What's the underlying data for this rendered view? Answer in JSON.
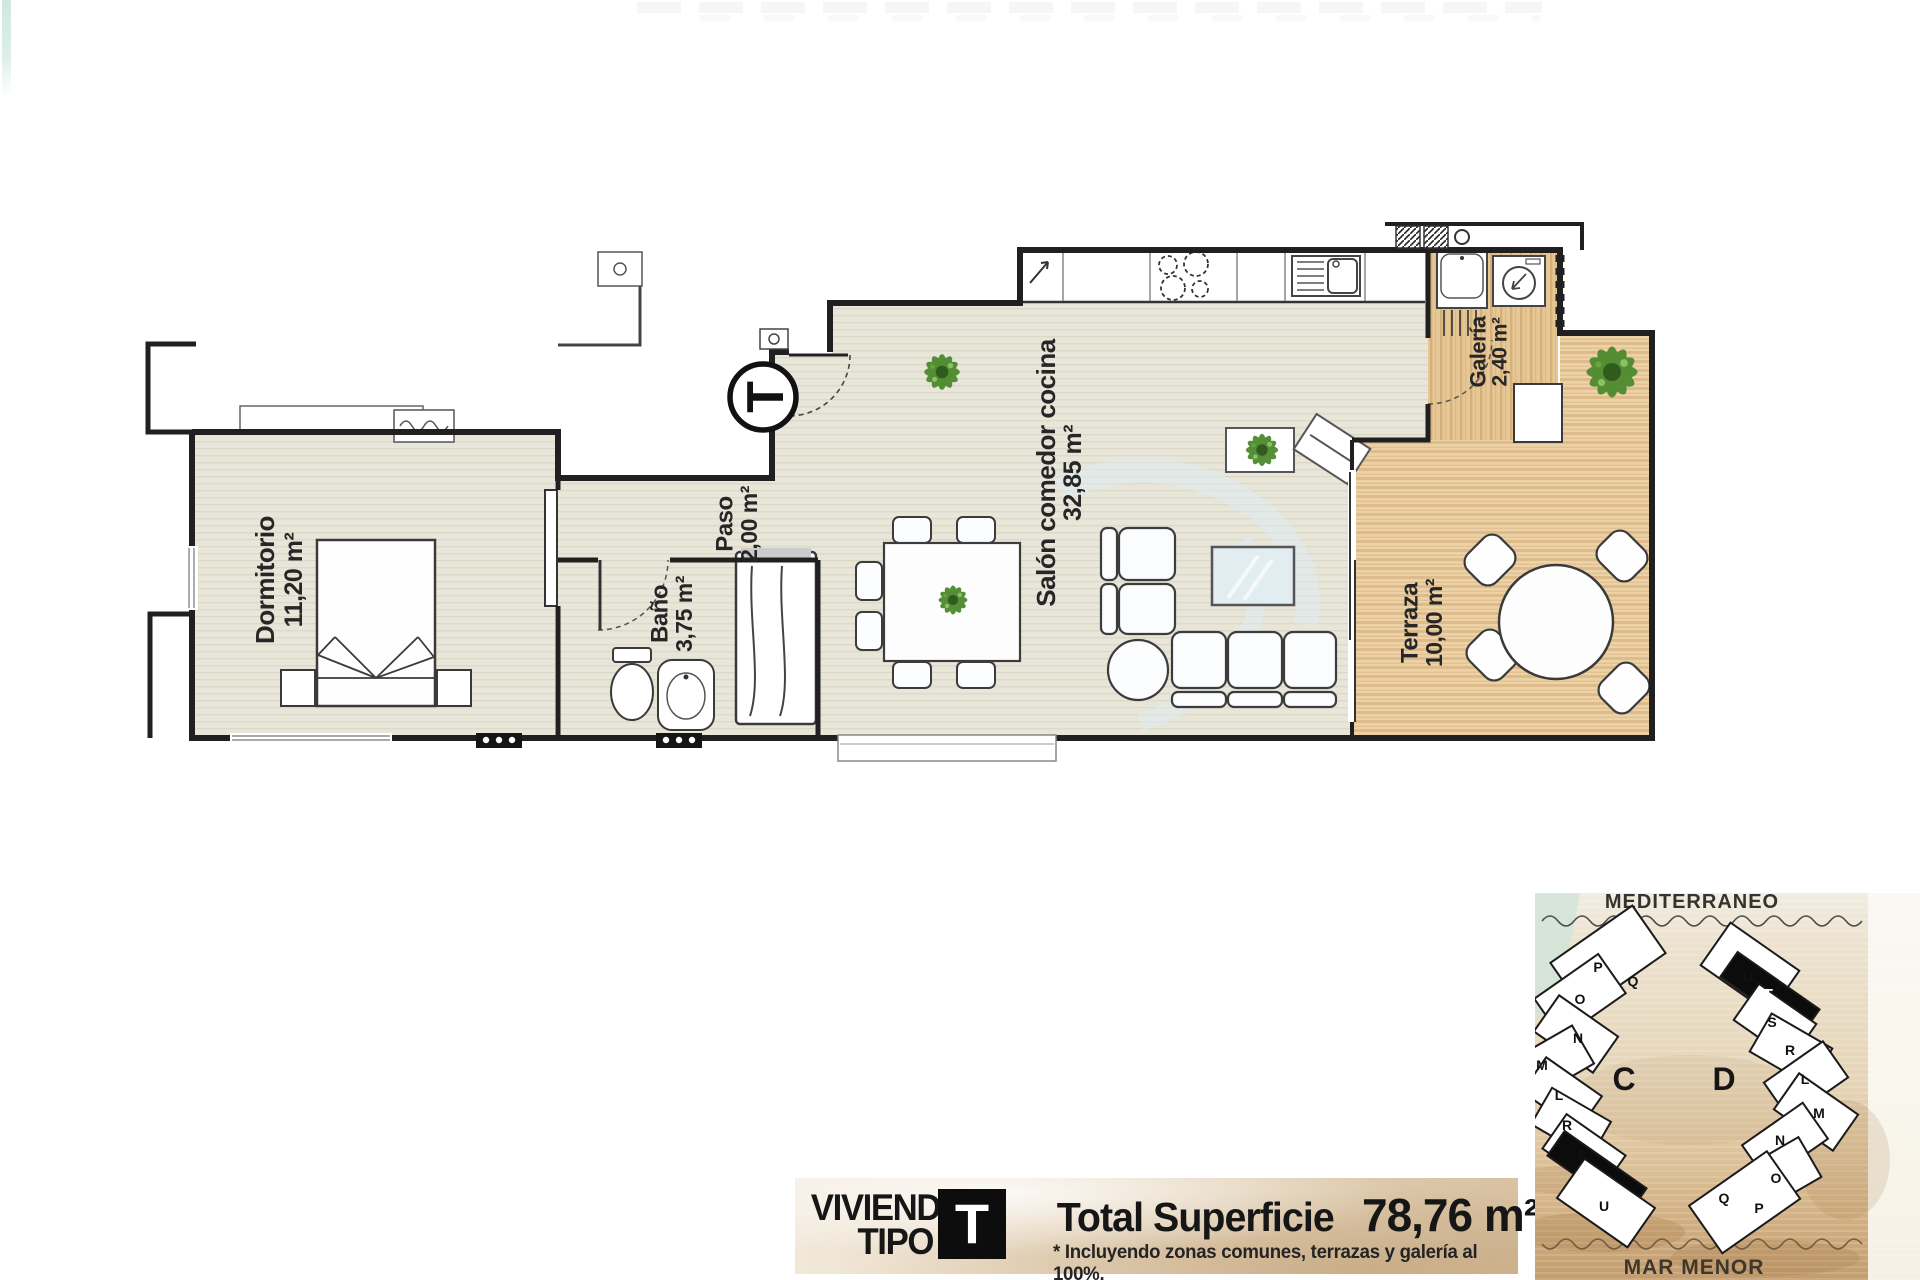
{
  "floorplan": {
    "entry_marker": "T",
    "rooms": {
      "dormitorio": {
        "name": "Dormitorio",
        "area": "11,20 m²"
      },
      "paso": {
        "name": "Paso",
        "area": "2,00 m²"
      },
      "bano": {
        "name": "Baño",
        "area": "3,75 m²"
      },
      "salon": {
        "name": "Salón comedor cocina",
        "area": "32,85 m²"
      },
      "galeria": {
        "name": "Galería",
        "area": "2,40 m²"
      },
      "terraza": {
        "name": "Terraza",
        "area": "10,00 m²"
      }
    }
  },
  "banner": {
    "title_line1": "VIVIENDA",
    "title_line2": "TIPO",
    "type_letter": "T",
    "total_label": "Total Superficie",
    "total_value": "78,76 m²",
    "footnote": "* Incluyendo zonas comunes, terrazas y galería al 100%."
  },
  "sitemap": {
    "sea_label_top": "MEDITERRÁNEO",
    "sea_label_bottom": "MAR MENOR",
    "block_left_label": "C",
    "block_right_label": "D",
    "left_building_units": [
      "P",
      "Q",
      "O",
      "N",
      "M",
      "L",
      "R",
      "S",
      "T",
      "U"
    ],
    "right_building_units": [
      "U",
      "T",
      "S",
      "R",
      "L",
      "M",
      "N",
      "O",
      "Q",
      "P"
    ]
  },
  "colors": {
    "wall": "#202020",
    "floor_tile": "#e8e5d9",
    "wood_deck": "#e7c795",
    "sand": "#dfc59e",
    "water": "#cfe5da",
    "highlight_block": "#0c0c0c"
  }
}
